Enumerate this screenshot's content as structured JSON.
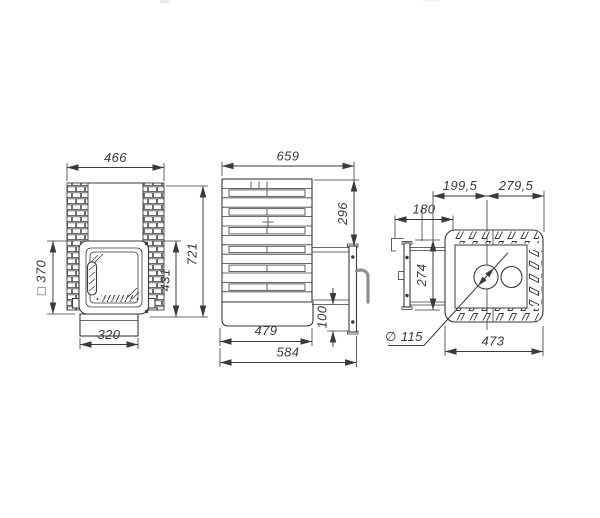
{
  "colors": {
    "line": "#3a3a3a",
    "handle": "#8f8f8f",
    "background": "#ffffff"
  },
  "views": {
    "front": {
      "overall_width": "466",
      "door_size": "□ 370",
      "firebox_height": "431",
      "overall_height": "721",
      "base_width": "320"
    },
    "side": {
      "overall_depth": "659",
      "top_to_door_frame": "296",
      "base_height": "100",
      "body_depth": "479",
      "depth_with_frame": "584"
    },
    "top": {
      "front_to_flue_center": "199,5",
      "flue_center_to_back": "279,5",
      "frame_offset": "180",
      "opening_width": "274",
      "flue_diameter": "∅ 115",
      "body_width": "473"
    }
  }
}
